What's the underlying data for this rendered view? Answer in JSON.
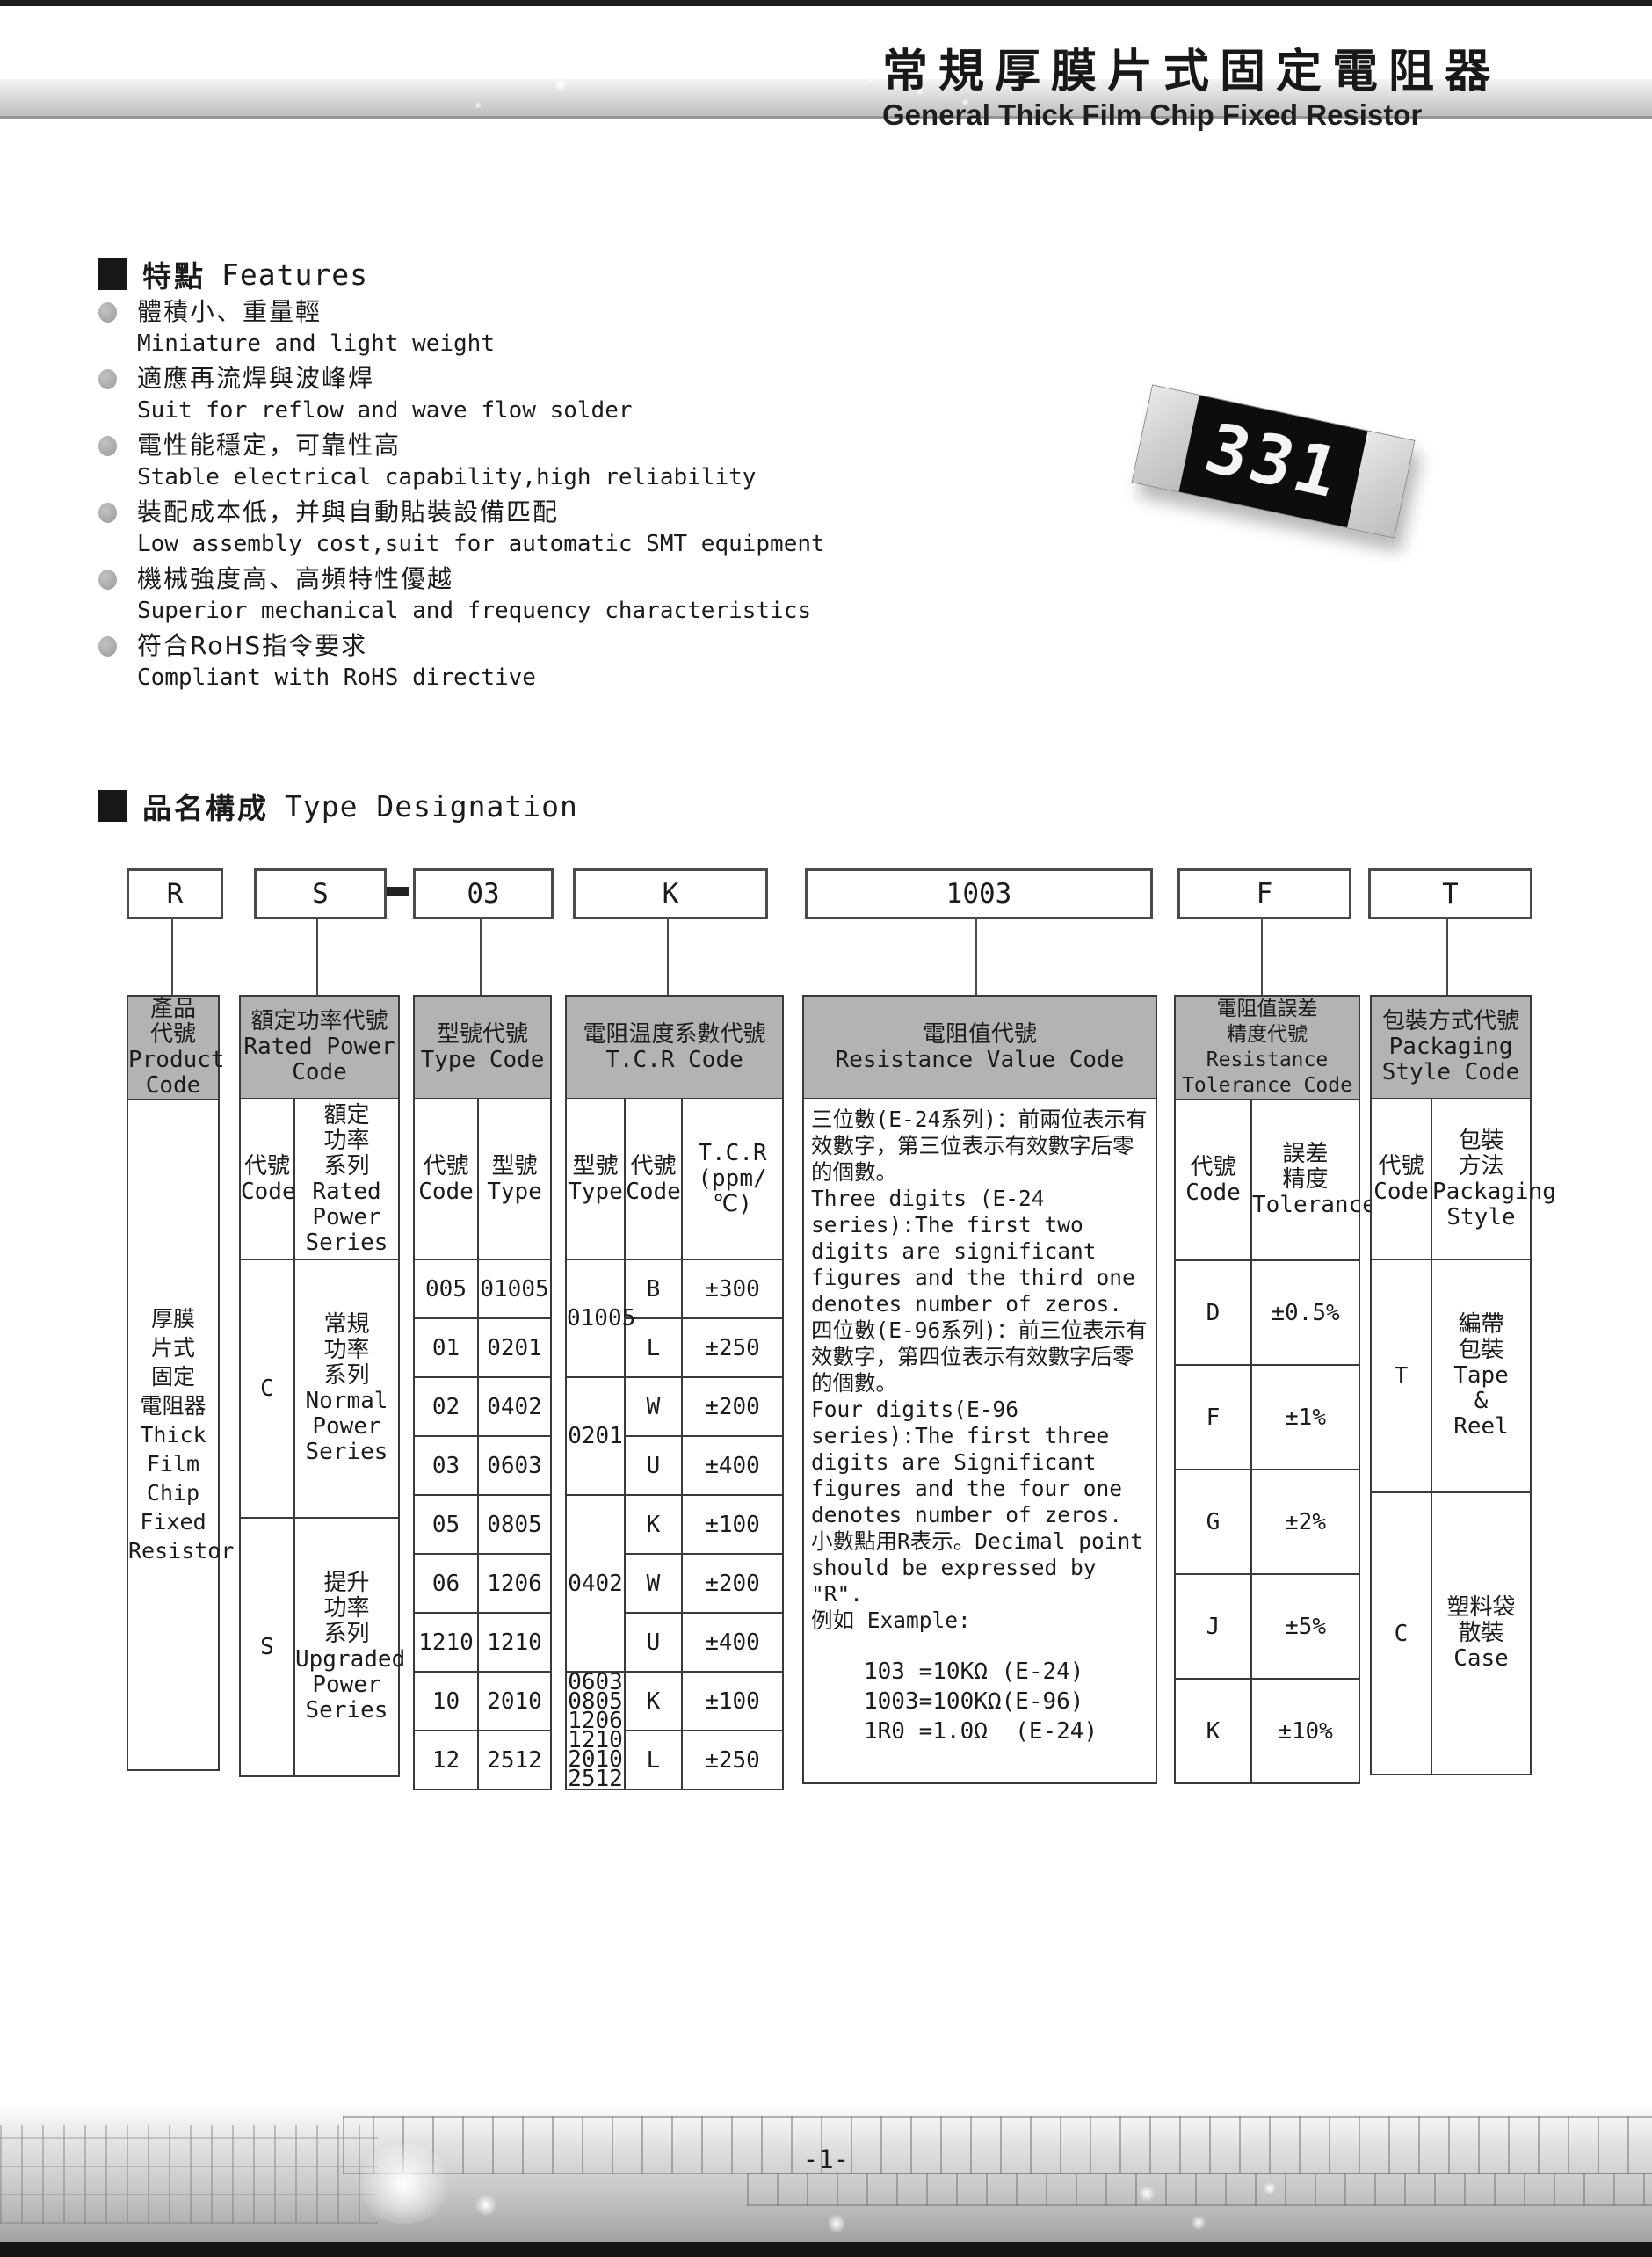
{
  "page": {
    "title_cn": "常規厚膜片式固定電阻器",
    "title_en": "General Thick Film Chip Fixed Resistor",
    "page_number": "-1-"
  },
  "chip": {
    "marking": "331"
  },
  "features": {
    "heading_cn": "特點",
    "heading_en": "Features",
    "items": [
      {
        "cn": "體積小、重量輕",
        "en": "Miniature and light weight"
      },
      {
        "cn": "適應再流焊與波峰焊",
        "en": "Suit for reflow and wave flow solder"
      },
      {
        "cn": "電性能穩定，可靠性高",
        "en": "Stable electrical capability,high reliability"
      },
      {
        "cn": "裝配成本低，并與自動貼裝設備匹配",
        "en": "Low assembly cost,suit for automatic SMT equipment"
      },
      {
        "cn": "機械強度高、高頻特性優越",
        "en": "Superior mechanical and frequency characteristics"
      },
      {
        "cn": "符合RoHS指令要求",
        "en": "Compliant with RoHS directive"
      }
    ]
  },
  "designation": {
    "heading_cn": "品名構成",
    "heading_en": "Type Designation",
    "codes": {
      "product": "R",
      "power": "S",
      "type": "03",
      "tcr": "K",
      "value": "1003",
      "tolerance": "F",
      "packaging": "T"
    }
  },
  "table": {
    "product": {
      "header": "產品\n代號\nProduct\nCode",
      "body": "厚膜\n片式\n固定\n電阻器\nThick\nFilm\nChip\nFixed\nResistor"
    },
    "rated_power": {
      "header": "額定功率代號\nRated Power\nCode",
      "sub_code": "代號\nCode",
      "sub_series": "額定\n功率\n系列\nRated\nPower\nSeries",
      "rows": [
        {
          "code": "C",
          "series": "常規\n功率\n系列\nNormal\nPower\nSeries"
        },
        {
          "code": "S",
          "series": "提升\n功率\n系列\nUpgraded\nPower\nSeries"
        }
      ]
    },
    "type_code": {
      "header": "型號代號\nType Code",
      "sub_code": "代號\nCode",
      "sub_type": "型號\nType",
      "rows": [
        [
          "005",
          "01005"
        ],
        [
          "01",
          "0201"
        ],
        [
          "02",
          "0402"
        ],
        [
          "03",
          "0603"
        ],
        [
          "05",
          "0805"
        ],
        [
          "06",
          "1206"
        ],
        [
          "1210",
          "1210"
        ],
        [
          "10",
          "2010"
        ],
        [
          "12",
          "2512"
        ]
      ]
    },
    "tcr": {
      "header": "電阻温度系數代號\nT.C.R Code",
      "sub_type": "型號\nType",
      "sub_code": "代號\nCode",
      "sub_tcr": "T.C.R\n(ppm/℃)",
      "groups": [
        {
          "type": "01005",
          "rows": [
            [
              "B",
              "±300"
            ],
            [
              "L",
              "±250"
            ]
          ]
        },
        {
          "type": "0201",
          "rows": [
            [
              "W",
              "±200"
            ],
            [
              "U",
              "±400"
            ]
          ]
        },
        {
          "type": "0402",
          "rows": [
            [
              "K",
              "±100"
            ],
            [
              "W",
              "±200"
            ],
            [
              "U",
              "±400"
            ]
          ]
        },
        {
          "type": "0603\n0805\n1206\n1210\n2010\n2512",
          "rows": [
            [
              "K",
              "±100"
            ],
            [
              "L",
              "±250"
            ]
          ]
        }
      ]
    },
    "resistance_value": {
      "header": "電阻值代號\nResistance Value Code",
      "paragraphs": [
        "三位數(E-24系列)：前兩位表示有效數字，第三位表示有效數字后零的個數。",
        "Three digits (E-24 series):The first two digits are significant figures and the third one denotes number of zeros.",
        "四位數(E-96系列)：前三位表示有效數字，第四位表示有效數字后零的個數。",
        "Four digits(E-96 series):The first three digits are Significant figures and the four one denotes number of zeros.",
        "小數點用R表示。Decimal point should be expressed by \"R\".",
        "例如 Example:"
      ],
      "examples": [
        "103 =10KΩ (E-24)",
        "1003=100KΩ(E-96)",
        "1R0 =1.0Ω  (E-24)"
      ]
    },
    "tolerance": {
      "header": "電阻值誤差\n精度代號\nResistance\nTolerance Code",
      "sub_code": "代號\nCode",
      "sub_tol": "誤差\n精度\nTolerance",
      "rows": [
        [
          "D",
          "±0.5%"
        ],
        [
          "F",
          "±1%"
        ],
        [
          "G",
          "±2%"
        ],
        [
          "J",
          "±5%"
        ],
        [
          "K",
          "±10%"
        ]
      ]
    },
    "packaging": {
      "header": "包裝方式代號\nPackaging\nStyle Code",
      "sub_code": "代號\nCode",
      "sub_style": "包裝\n方法\nPackaging\nStyle",
      "rows": [
        {
          "code": "T",
          "style": "編帶\n包裝\nTape\n&\nReel"
        },
        {
          "code": "C",
          "style": "塑料袋\n散裝\nCase"
        }
      ]
    }
  }
}
